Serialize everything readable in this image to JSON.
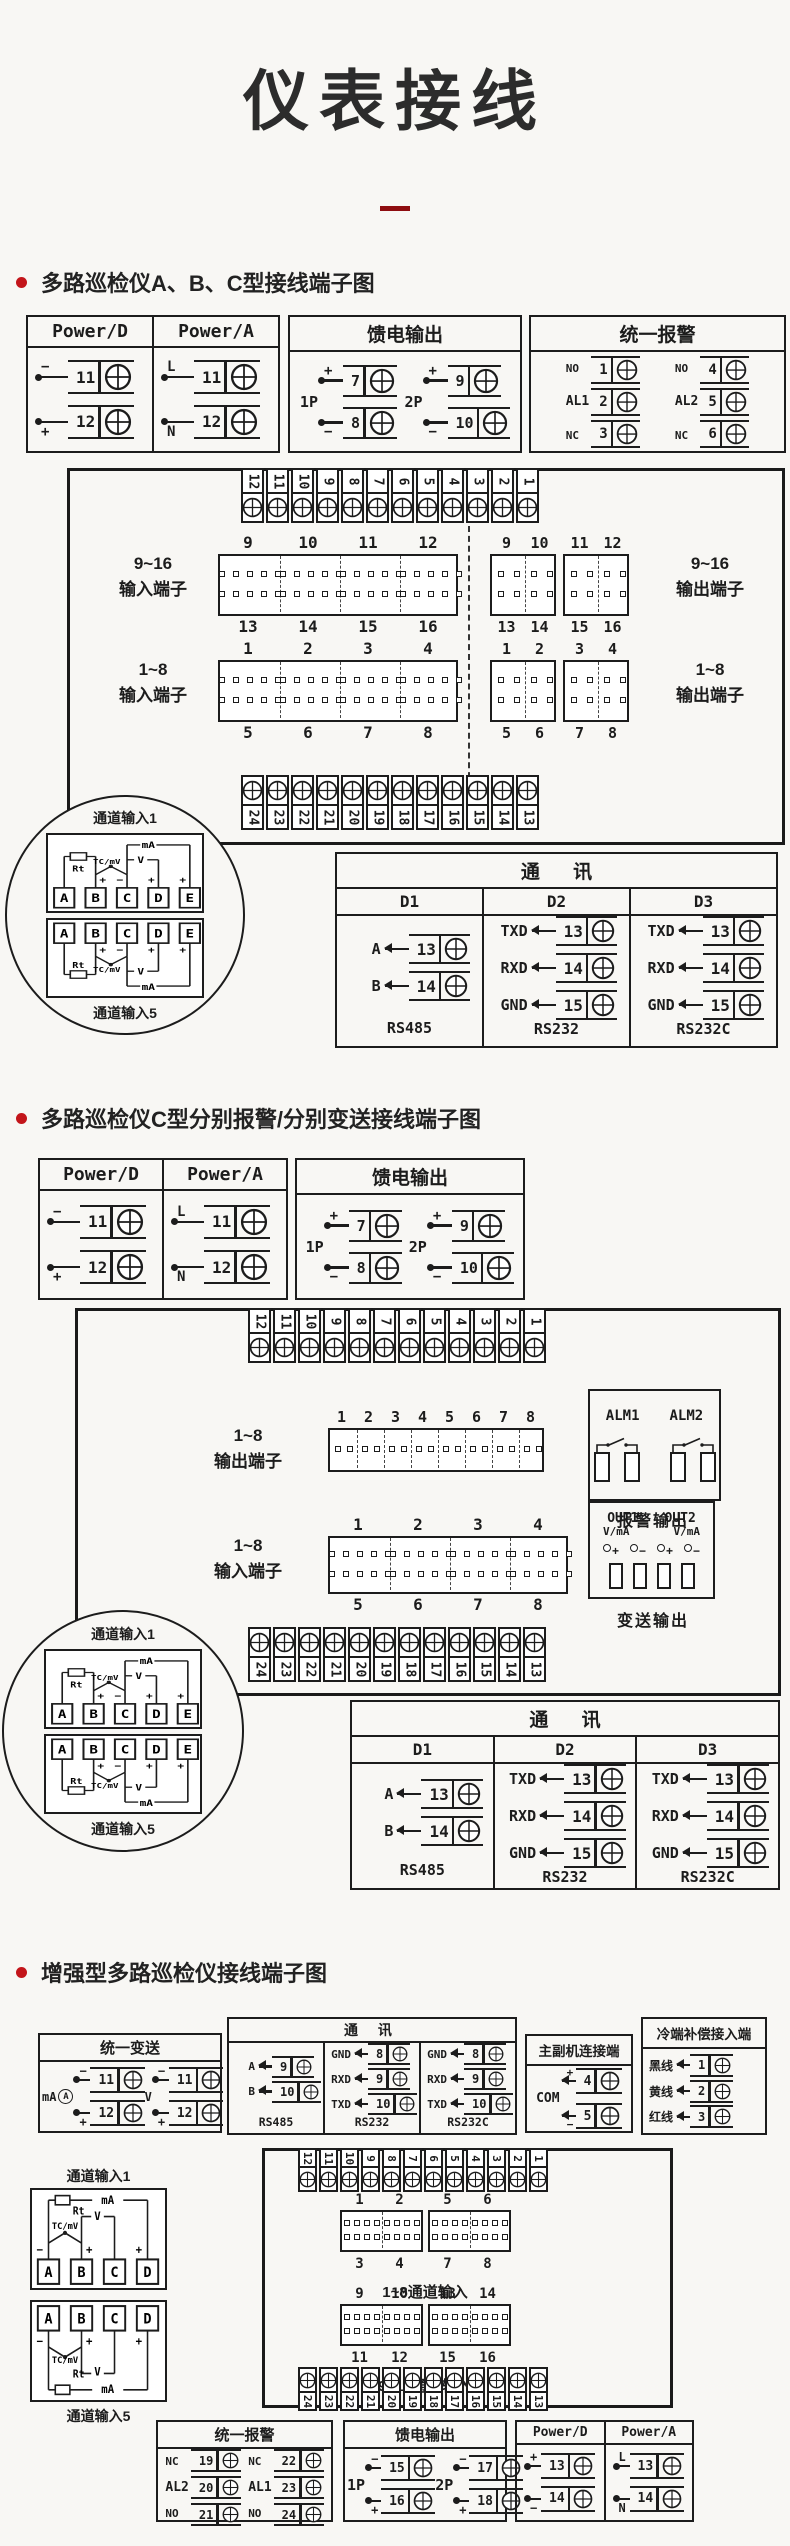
{
  "page": {
    "title": "仪表接线",
    "accent_red": "#c3151a",
    "ink": "#1c1c1c",
    "bg": "#f8f7f4"
  },
  "s1": {
    "heading": "多路巡检仪A、B、C型接线端子图",
    "power_box": {
      "cols": [
        {
          "title": "Power/D",
          "terminals": [
            {
              "sign": "−",
              "num": "11"
            },
            {
              "sign": "+",
              "num": "12"
            }
          ]
        },
        {
          "title": "Power/A",
          "terminals": [
            {
              "sign": "L",
              "num": "11"
            },
            {
              "sign": "N",
              "num": "12"
            }
          ]
        }
      ]
    },
    "feed_box": {
      "title": "馈电输出",
      "groups": [
        {
          "label": "1P",
          "terminals": [
            {
              "sign": "+",
              "num": "7"
            },
            {
              "sign": "−",
              "num": "8"
            }
          ]
        },
        {
          "label": "2P",
          "terminals": [
            {
              "sign": "+",
              "num": "9"
            },
            {
              "sign": "−",
              "num": "10"
            }
          ]
        }
      ]
    },
    "alarm_box": {
      "title": "统一报警",
      "groups": [
        {
          "label": "AL1",
          "contact_top": "NO",
          "contact_bottom": "NC",
          "nums": [
            "1",
            "2",
            "3"
          ]
        },
        {
          "label": "AL2",
          "contact_top": "NO",
          "contact_bottom": "NC",
          "nums": [
            "4",
            "5",
            "6"
          ]
        }
      ]
    },
    "top_strip": [
      "12",
      "11",
      "10",
      "9",
      "8",
      "7",
      "6",
      "5",
      "4",
      "3",
      "2",
      "1"
    ],
    "bottom_strip": [
      "24",
      "23",
      "22",
      "21",
      "20",
      "19",
      "18",
      "17",
      "16",
      "15",
      "14",
      "13"
    ],
    "input916": {
      "label": [
        "9~16",
        "输入端子"
      ],
      "top": [
        "9",
        "10",
        "11",
        "12"
      ],
      "bottom": [
        "13",
        "14",
        "15",
        "16"
      ]
    },
    "output916": {
      "label": [
        "9~16",
        "输出端子"
      ],
      "blocks": [
        {
          "top": [
            "9",
            "10"
          ],
          "bottom": [
            "13",
            "14"
          ]
        },
        {
          "top": [
            "11",
            "12"
          ],
          "bottom": [
            "15",
            "16"
          ]
        }
      ]
    },
    "input18": {
      "label": [
        "1~8",
        "输入端子"
      ],
      "top": [
        "1",
        "2",
        "3",
        "4"
      ],
      "bottom": [
        "5",
        "6",
        "7",
        "8"
      ]
    },
    "output18": {
      "label": [
        "1~8",
        "输出端子"
      ],
      "blocks": [
        {
          "top": [
            "1",
            "2"
          ],
          "bottom": [
            "5",
            "6"
          ]
        },
        {
          "top": [
            "3",
            "4"
          ],
          "bottom": [
            "7",
            "8"
          ]
        }
      ]
    },
    "callout": {
      "top_label": "通道输入1",
      "bottom_label": "通道输入5",
      "terminals": [
        "A",
        "B",
        "C",
        "D",
        "E"
      ],
      "wires": {
        "rt": "Rt",
        "tc": "TC/mV",
        "v": "V",
        "ma": "mA"
      }
    },
    "comm": {
      "title": "通 讯",
      "columns": [
        {
          "header": "D1",
          "rows": [
            {
              "sig": "A",
              "num": "13"
            },
            {
              "sig": "B",
              "num": "14"
            }
          ],
          "caption": "RS485"
        },
        {
          "header": "D2",
          "rows": [
            {
              "sig": "TXD",
              "num": "13"
            },
            {
              "sig": "RXD",
              "num": "14"
            },
            {
              "sig": "GND",
              "num": "15"
            }
          ],
          "caption": "RS232"
        },
        {
          "header": "D3",
          "rows": [
            {
              "sig": "TXD",
              "num": "13"
            },
            {
              "sig": "RXD",
              "num": "14"
            },
            {
              "sig": "GND",
              "num": "15"
            }
          ],
          "caption": "RS232C"
        }
      ]
    }
  },
  "s2": {
    "heading": "多路巡检仪C型分别报警/分别变送接线端子图",
    "power_box": {
      "cols": [
        {
          "title": "Power/D",
          "terminals": [
            {
              "sign": "−",
              "num": "11"
            },
            {
              "sign": "+",
              "num": "12"
            }
          ]
        },
        {
          "title": "Power/A",
          "terminals": [
            {
              "sign": "L",
              "num": "11"
            },
            {
              "sign": "N",
              "num": "12"
            }
          ]
        }
      ]
    },
    "feed_box": {
      "title": "馈电输出",
      "groups": [
        {
          "label": "1P",
          "terminals": [
            {
              "sign": "+",
              "num": "7"
            },
            {
              "sign": "−",
              "num": "8"
            }
          ]
        },
        {
          "label": "2P",
          "terminals": [
            {
              "sign": "+",
              "num": "9"
            },
            {
              "sign": "−",
              "num": "10"
            }
          ]
        }
      ]
    },
    "top_strip": [
      "12",
      "11",
      "10",
      "9",
      "8",
      "7",
      "6",
      "5",
      "4",
      "3",
      "2",
      "1"
    ],
    "bottom_strip": [
      "24",
      "23",
      "22",
      "21",
      "20",
      "19",
      "18",
      "17",
      "16",
      "15",
      "14",
      "13"
    ],
    "output18_row": {
      "label": [
        "1~8",
        "输出端子"
      ],
      "top": [
        "1",
        "2",
        "3",
        "4",
        "5",
        "6",
        "7",
        "8"
      ]
    },
    "input18": {
      "label": [
        "1~8",
        "输入端子"
      ],
      "top": [
        "1",
        "2",
        "3",
        "4"
      ],
      "bottom": [
        "5",
        "6",
        "7",
        "8"
      ]
    },
    "alm_box": {
      "labels": [
        "ALM1",
        "ALM2"
      ],
      "caption": "报警输出"
    },
    "out_box": {
      "labels": [
        "OUT1",
        "OUT2"
      ],
      "sub": "V/mA",
      "signs": [
        "+",
        "−",
        "+",
        "−"
      ],
      "caption": "变送输出"
    },
    "callout": {
      "top_label": "通道输入1",
      "bottom_label": "通道输入5",
      "terminals": [
        "A",
        "B",
        "C",
        "D",
        "E"
      ],
      "wires": {
        "rt": "Rt",
        "tc": "TC/mV",
        "v": "V",
        "ma": "mA"
      }
    },
    "comm": {
      "title": "通 讯",
      "columns": [
        {
          "header": "D1",
          "rows": [
            {
              "sig": "A",
              "num": "13"
            },
            {
              "sig": "B",
              "num": "14"
            }
          ],
          "caption": "RS485"
        },
        {
          "header": "D2",
          "rows": [
            {
              "sig": "TXD",
              "num": "13"
            },
            {
              "sig": "RXD",
              "num": "14"
            },
            {
              "sig": "GND",
              "num": "15"
            }
          ],
          "caption": "RS232"
        },
        {
          "header": "D3",
          "rows": [
            {
              "sig": "TXD",
              "num": "13"
            },
            {
              "sig": "RXD",
              "num": "14"
            },
            {
              "sig": "GND",
              "num": "15"
            }
          ],
          "caption": "RS232C"
        }
      ]
    }
  },
  "s3": {
    "heading": "增强型多路巡检仪接线端子图",
    "transmit_box": {
      "title": "统一变送",
      "groups": [
        {
          "label": "mA",
          "meter": "A",
          "terminals": [
            {
              "sign": "−",
              "num": "11"
            },
            {
              "sign": "+",
              "num": "12"
            }
          ]
        },
        {
          "label": "V",
          "terminals": [
            {
              "sign": "−",
              "num": "11"
            },
            {
              "sign": "+",
              "num": "12"
            }
          ]
        }
      ]
    },
    "comm": {
      "title": "通 讯",
      "columns": [
        {
          "rows": [
            {
              "sig": "A",
              "num": "9"
            },
            {
              "sig": "B",
              "num": "10"
            }
          ],
          "caption": "RS485"
        },
        {
          "rows": [
            {
              "sig": "GND",
              "num": "8"
            },
            {
              "sig": "RXD",
              "num": "9"
            },
            {
              "sig": "TXD",
              "num": "10"
            }
          ],
          "caption": "RS232"
        },
        {
          "rows": [
            {
              "sig": "GND",
              "num": "8"
            },
            {
              "sig": "RXD",
              "num": "9"
            },
            {
              "sig": "TXD",
              "num": "10"
            }
          ],
          "caption": "RS232C"
        }
      ]
    },
    "link_box": {
      "title": "主副机连接端",
      "com": "COM",
      "terminals": [
        {
          "sign": "+",
          "num": "4"
        },
        {
          "sign": "−",
          "num": "5"
        }
      ]
    },
    "cold_box": {
      "title": "冷端补偿接入端",
      "rows": [
        {
          "sig": "黑线",
          "num": "1"
        },
        {
          "sig": "黄线",
          "num": "2"
        },
        {
          "sig": "红线",
          "num": "3"
        }
      ]
    },
    "channel": {
      "top_label": "通道输入1",
      "bottom_label": "通道输入5",
      "terminals": [
        "A",
        "B",
        "C",
        "D"
      ],
      "wires": {
        "rt": "Rt",
        "tc": "TC/mV",
        "v": "V",
        "ma": "mA"
      }
    },
    "top_strip": [
      "12",
      "11",
      "10",
      "9",
      "8",
      "7",
      "6",
      "5",
      "4",
      "3",
      "2",
      "1"
    ],
    "bottom_strip": [
      "24",
      "23",
      "22",
      "21",
      "20",
      "19",
      "18",
      "17",
      "16",
      "15",
      "14",
      "13"
    ],
    "pair18": {
      "caption": "1~8通道输入",
      "blocks": [
        {
          "top": [
            "1",
            "2"
          ],
          "bottom": [
            "3",
            "4"
          ]
        },
        {
          "top": [
            "5",
            "6"
          ],
          "bottom": [
            "7",
            "8"
          ]
        }
      ]
    },
    "pair916": {
      "caption": "9~16通道输入",
      "blocks": [
        {
          "top": [
            "9",
            "10"
          ],
          "bottom": [
            "11",
            "12"
          ]
        },
        {
          "top": [
            "13",
            "14"
          ],
          "bottom": [
            "15",
            "16"
          ]
        }
      ]
    },
    "alarm_box": {
      "title": "统一报警",
      "groups": [
        {
          "label": "AL2",
          "contact_top": "NC",
          "contact_bottom": "NO",
          "nums": [
            "19",
            "20",
            "21"
          ]
        },
        {
          "label": "AL1",
          "contact_top": "NC",
          "contact_bottom": "NO",
          "nums": [
            "22",
            "23",
            "24"
          ]
        }
      ]
    },
    "feed_box": {
      "title": "馈电输出",
      "groups": [
        {
          "label": "1P",
          "terminals": [
            {
              "sign": "−",
              "num": "15"
            },
            {
              "sign": "+",
              "num": "16"
            }
          ]
        },
        {
          "label": "2P",
          "terminals": [
            {
              "sign": "−",
              "num": "17"
            },
            {
              "sign": "+",
              "num": "18"
            }
          ]
        }
      ]
    },
    "power_box": {
      "cols": [
        {
          "title": "Power/D",
          "terminals": [
            {
              "sign": "+",
              "num": "13"
            },
            {
              "sign": "−",
              "num": "14"
            }
          ]
        },
        {
          "title": "Power/A",
          "terminals": [
            {
              "sign": "L",
              "num": "13"
            },
            {
              "sign": "N",
              "num": "14"
            }
          ]
        }
      ]
    }
  }
}
